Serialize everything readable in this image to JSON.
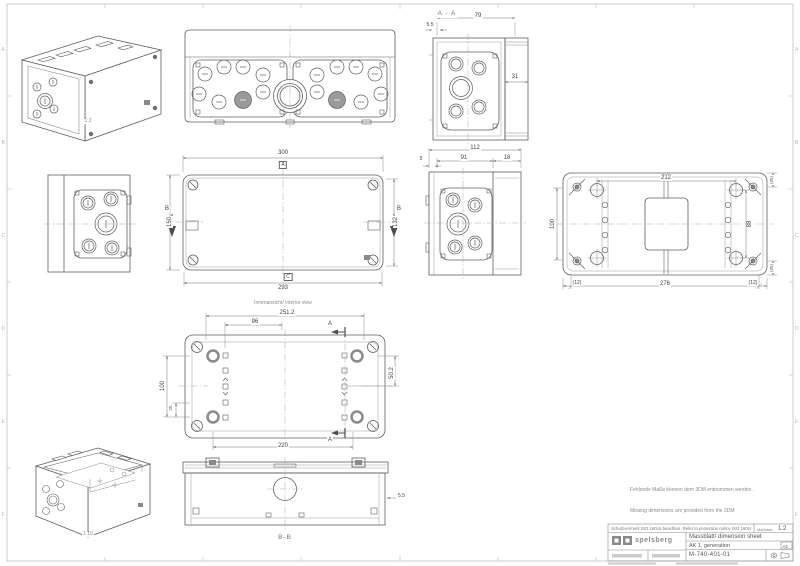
{
  "frame": {
    "rows": [
      "A",
      "B",
      "C",
      "D",
      "E",
      "F"
    ]
  },
  "scales": {
    "iso_closed": "1:2",
    "iso_open": "1:10"
  },
  "section_aa": {
    "title": "A - A",
    "dim_width": "79",
    "dim_wall": "5.5",
    "dim_depth": "31"
  },
  "lid": {
    "dim_width": "300",
    "dim_width_inner": "293",
    "dim_height": "150",
    "dim_height_inner": "132",
    "datum_top": "A",
    "datum_bottom": "C",
    "section_label": "B"
  },
  "end_view": {
    "dim_total": "112",
    "dim_body": "91",
    "dim_cover": "18",
    "dim_lip": "5"
  },
  "base": {
    "dim_top": "212",
    "dim_left": "100",
    "dim_right": "88",
    "dim_bottom": "276",
    "offset_left": "(12)",
    "offset_right": "(12)",
    "corner_top": "(25)",
    "corner_bottom": "(25)"
  },
  "interior": {
    "caption": "Innenansicht/ interior view",
    "dim_width": "251.2",
    "dim_width_inner": "96",
    "dim_height": "100",
    "dim_height_inner": "25",
    "dim_right": "50.2",
    "dim_bottom": "220",
    "section_label": "A"
  },
  "section_bb": {
    "title": "B-B",
    "dim_wall": "5.5"
  },
  "notes": {
    "de": "Fehlende Maße können dem 3DM entnommen werden.",
    "en": "Missing dimensions are provided from the 3DM"
  },
  "title_block": {
    "protection": "Schutzvermerk ISO 16016 beachten. Refer to protection notice ISO 16016.",
    "scale_label": "Maßstab",
    "scale_value": "1:2",
    "company": "spelsberg",
    "doc_title": "Massblatt/ dimension sheet",
    "doc_subtitle": "AK 1. generation",
    "doc_number": "M-740-401-01",
    "sheet_size": "A2"
  }
}
